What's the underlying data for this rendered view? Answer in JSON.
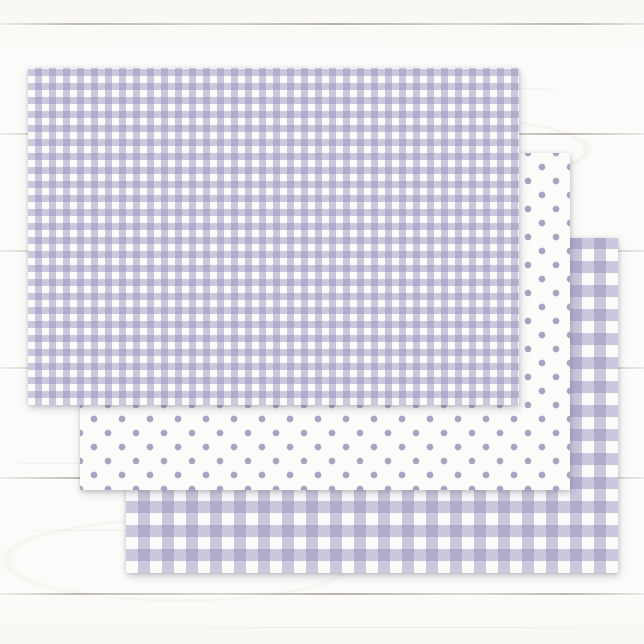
{
  "meta": {
    "description": "Product photo: three sheets of lavender patterned tissue wrapping paper fanned diagonally on a white shiplap wood surface",
    "visible_text": ""
  },
  "palette": {
    "paper_white": "#FCFBF9",
    "pattern_lavender": "#8E89B9",
    "gingham_stripe_alpha": 0.45,
    "dot_color": "#A7A3C1",
    "wood_base": "#FCFBF9",
    "plank_line_color": "#827D70",
    "sheet_shadow": "rgba(104,99,120,0.32)"
  },
  "background": {
    "type": "white-painted-wood-planks",
    "plank_lines_y": [
      23,
      133,
      250,
      367,
      477,
      593
    ],
    "grain_streaks": [
      {
        "y": 88,
        "x": 270,
        "w": 360,
        "alpha": 0.06
      },
      {
        "y": 463,
        "x": 0,
        "w": 110,
        "alpha": 0.07
      },
      {
        "y": 530,
        "x": 0,
        "w": 255,
        "alpha": 0.09
      },
      {
        "y": 627,
        "x": 140,
        "w": 504,
        "alpha": 0.11
      }
    ]
  },
  "sheets": [
    {
      "id": "gingham-large",
      "pattern": "gingham",
      "check_px": 12,
      "x": 126,
      "y": 238,
      "width": 492,
      "height": 335,
      "z": 1
    },
    {
      "id": "polka-dot",
      "pattern": "polka",
      "dot_radius_px": 3.3,
      "dot_spacing_px": 28,
      "x": 80,
      "y": 153,
      "width": 490,
      "height": 337,
      "z": 2
    },
    {
      "id": "gingham-small",
      "pattern": "gingham",
      "check_px": 7,
      "x": 28,
      "y": 68,
      "width": 491,
      "height": 337,
      "z": 3
    }
  ]
}
